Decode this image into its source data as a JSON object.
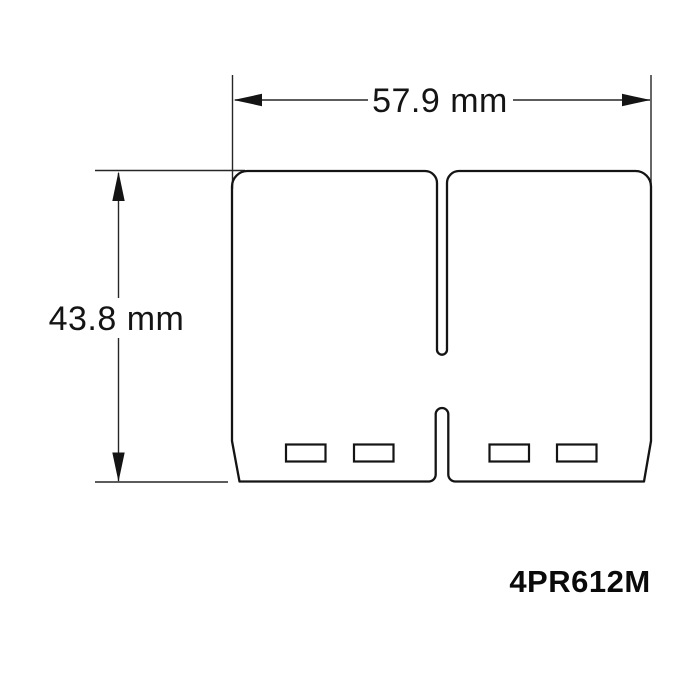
{
  "diagram": {
    "type": "technical-dimension-drawing",
    "subject": "reed-valve-petal-outline",
    "part_number": "4PR612M",
    "width_dimension": {
      "label": "57.9 mm"
    },
    "height_dimension": {
      "label": "43.8 mm"
    },
    "colors": {
      "background": "#ffffff",
      "line": "#141414",
      "text": "#141414"
    }
  }
}
